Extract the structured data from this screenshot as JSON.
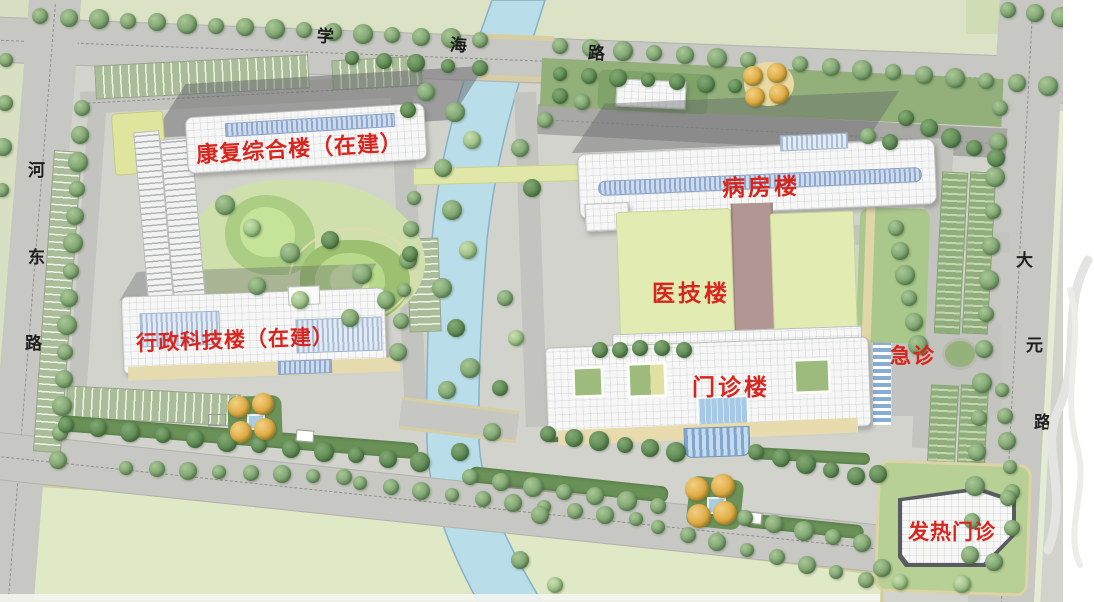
{
  "map_labels": {
    "roads": {
      "xuehai": {
        "name": "学海路",
        "chars": [
          "学",
          "海",
          "路"
        ]
      },
      "hedong": {
        "name": "河东路",
        "chars": [
          "河",
          "东",
          "路"
        ]
      },
      "dayuan": {
        "name": "大元路",
        "chars": [
          "大",
          "元",
          "路"
        ]
      }
    },
    "buildings": {
      "rehab": {
        "label": "康复综合楼（在建）"
      },
      "admin": {
        "label": "行政科技楼（在建）"
      },
      "ward": {
        "label": "病房楼"
      },
      "medtech": {
        "label": "医技楼"
      },
      "outpatient": {
        "label": "门诊楼"
      },
      "emergency": {
        "label": "急诊"
      },
      "fever": {
        "label": "发热门诊"
      }
    }
  },
  "colors": {
    "label_red": "#d8251d",
    "road_text_black": "#1e1e1e",
    "road_gray": "#c7c8c3",
    "campus_pavement_gray": "#d2d3cd",
    "canal_blue": "#b9dde9",
    "tree_green": "#7fa471",
    "lawn_green": "#b7d095",
    "field_pale_green": "#e0e9c6",
    "building_white": "#f7f8f6",
    "skylight_blue": "#8fa8cc",
    "corridor_mauve": "#b19694",
    "medtech_roof_green": "#e2ecb2",
    "gate_tree_orange": "#dfa93f"
  }
}
